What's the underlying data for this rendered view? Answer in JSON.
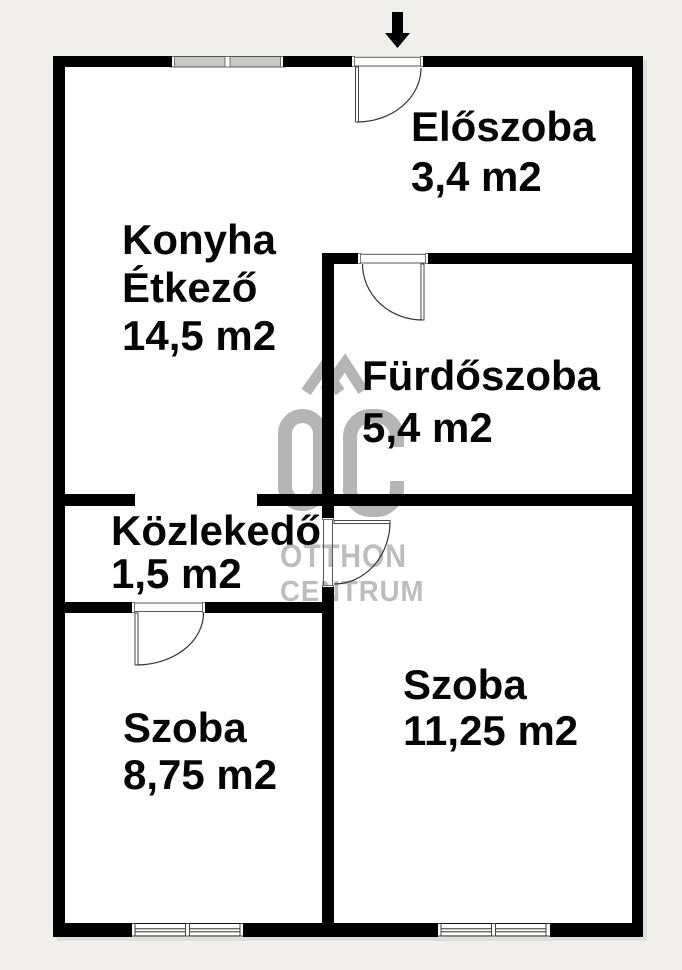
{
  "plan": {
    "rooms": [
      {
        "name": "Előszoba",
        "area": "3,4 m2"
      },
      {
        "name": "Konyha",
        "name2": "Étkező",
        "area": "14,5 m2"
      },
      {
        "name": "Fürdőszoba",
        "area": "5,4 m2"
      },
      {
        "name": "Közlekedő",
        "area": "1,5 m2"
      },
      {
        "name": "Szoba",
        "area": "8,75 m2"
      },
      {
        "name": "Szoba",
        "area": "11,25 m2"
      }
    ],
    "watermark": {
      "logo_text": "ŐC",
      "line1": "OTTHON",
      "line2": "CENTRUM"
    },
    "colors": {
      "wall": "#000000",
      "background": "#f0efeb",
      "floor": "#ffffff",
      "watermark": "#b5b5b5",
      "window_fill": "#c9c9c9"
    }
  }
}
